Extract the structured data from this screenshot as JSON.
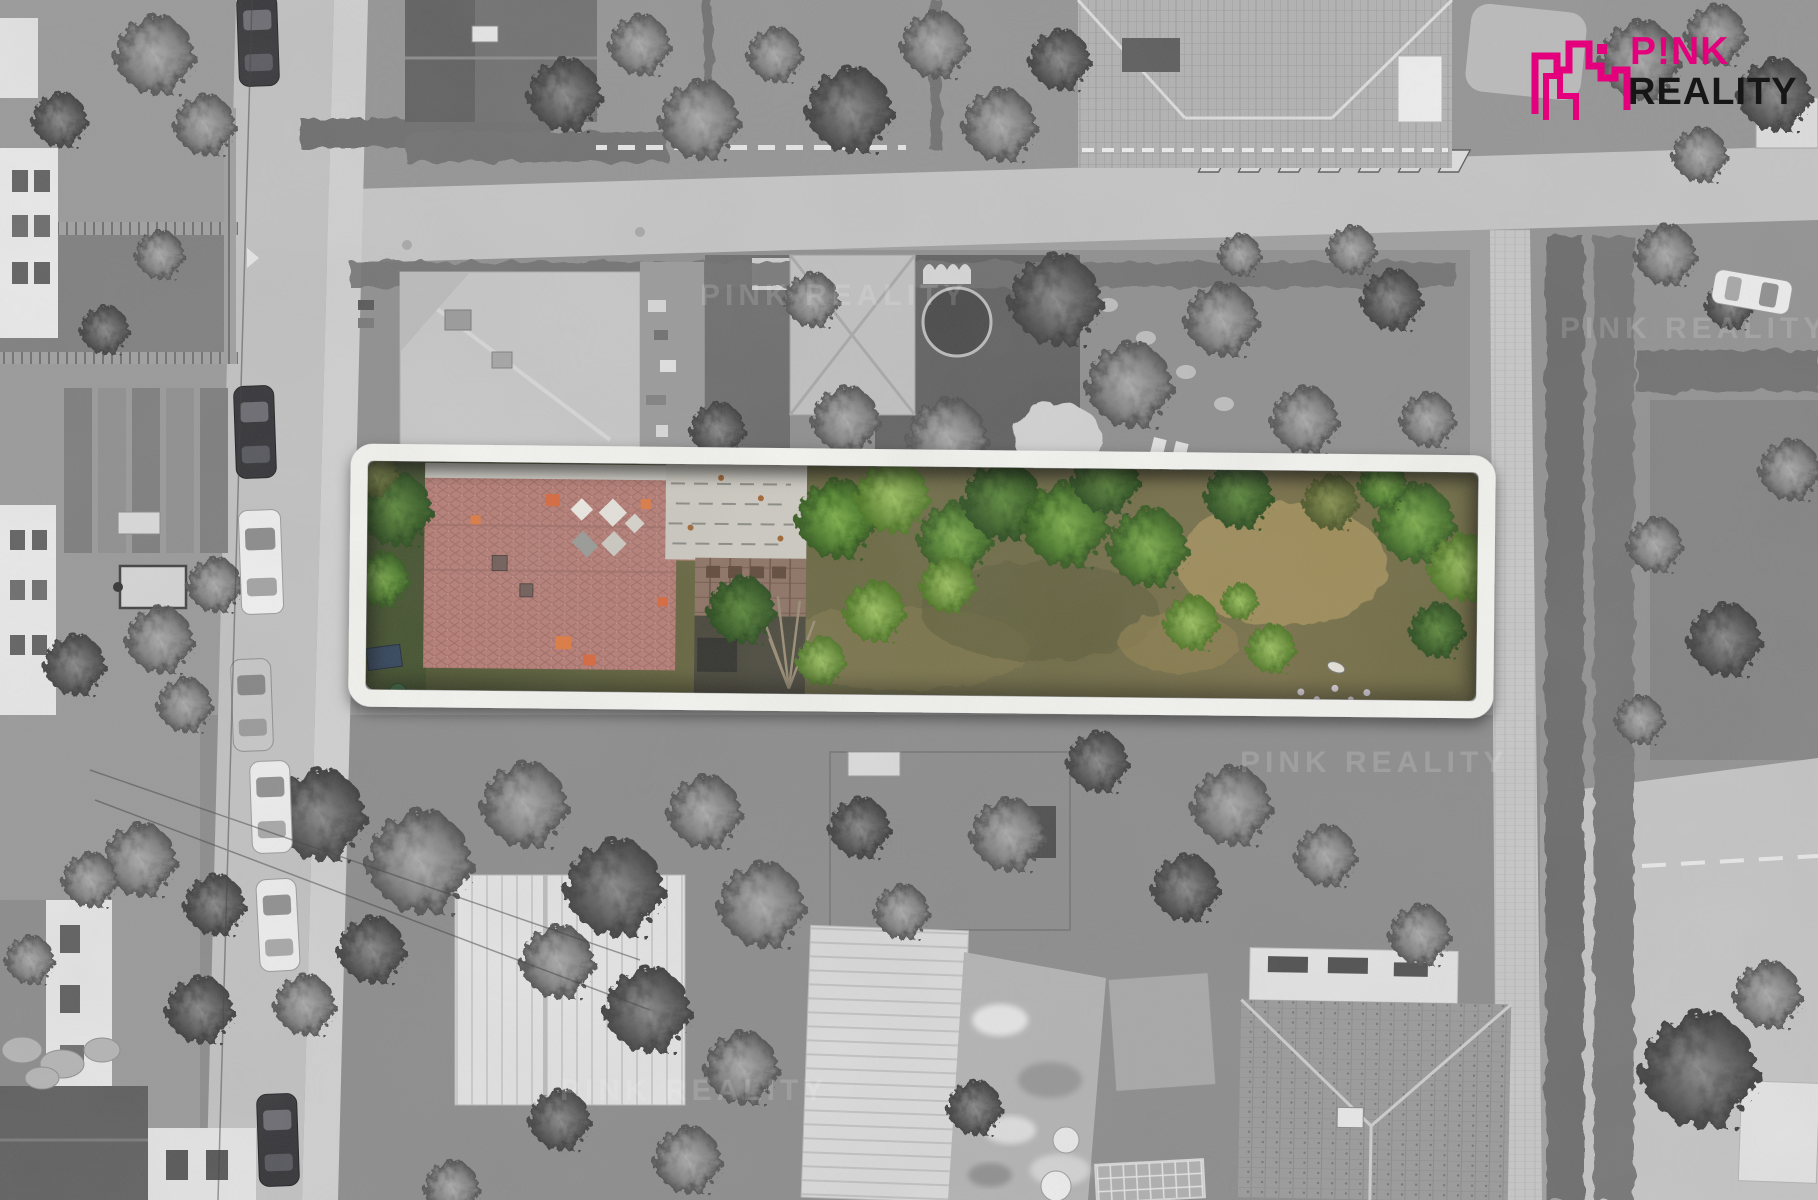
{
  "brand": {
    "name_line1": "P!NK",
    "name_line2": "REALITY",
    "pink": "#e4007c",
    "black": "#161616",
    "icon": "city-skyline-icon"
  },
  "watermark": {
    "text": "PINK REALITY"
  },
  "photo": {
    "type": "aerial-drone-photo",
    "treatment": "black-and-white neighborhood with one parcel highlighted in color",
    "parcel_frame_color": "#f6f6f2",
    "parcel_contents": [
      "red-tile-roof-house",
      "weathered-outbuilding",
      "brick-wall-courtyard",
      "long-garden-with-trees"
    ],
    "palette": {
      "roof_red": "#b77d75",
      "patch_orange": "#d9673a",
      "tree_green": "#4e7f2b",
      "lawn_olive": "#6e6a44",
      "dry_grass": "#a3905a"
    }
  }
}
